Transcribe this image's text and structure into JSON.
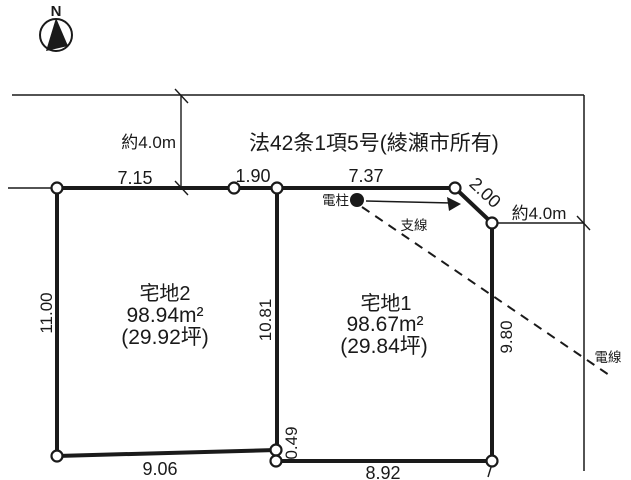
{
  "compass": {
    "north_label": "N"
  },
  "road": {
    "designation": "法42条1項5号(綾瀬市所有)",
    "top_width": "約4.0m",
    "right_width": "約4.0m"
  },
  "parcels": {
    "parcel2": {
      "name": "宅地2",
      "area": "98.94m²",
      "area_tsubo": "(29.92坪)"
    },
    "parcel1": {
      "name": "宅地1",
      "area": "98.67m²",
      "area_tsubo": "(29.84坪)"
    }
  },
  "dimensions": {
    "p2_top": "7.15",
    "top_middle": "1.90",
    "p1_top": "7.37",
    "p1_corner": "2.00",
    "p2_left": "11.00",
    "p2_right": "10.81",
    "p1_right": "9.80",
    "step": "0.49",
    "p2_bottom": "9.06",
    "p1_bottom": "8.92"
  },
  "utilities": {
    "pole": "電柱",
    "guy_wire": "支線",
    "power_line": "電線"
  },
  "colors": {
    "ink": "#1a1a1a",
    "background": "#ffffff"
  }
}
